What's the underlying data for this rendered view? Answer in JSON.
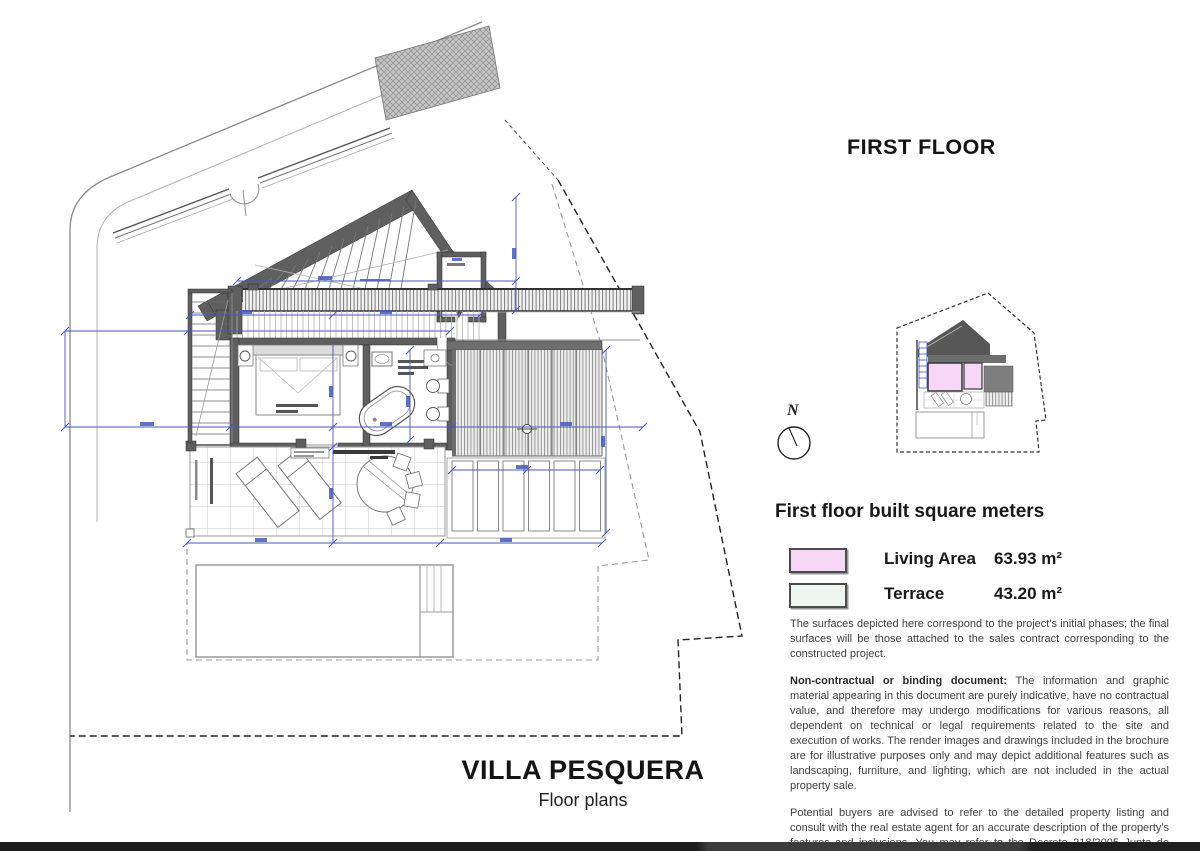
{
  "header": {
    "floor_title": "FIRST FLOOR"
  },
  "compass": {
    "label": "N"
  },
  "legend": {
    "title": "First floor built square meters",
    "items": [
      {
        "label": "Living Area",
        "value": "63.93 m²",
        "color": "#f6d7f6"
      },
      {
        "label": "Terrace",
        "value": "43.20 m²",
        "color": "#eef6f0"
      }
    ]
  },
  "notes": {
    "surfaces": "The surfaces depicted here correspond to the project's initial phases; the final surfaces will be those attached to the sales contract corresponding to the constructed project.",
    "non_contractual_lead": "Non-contractual or binding document:",
    "non_contractual_body": " The information and graphic material appearing in this document are purely indicative, have no contractual value, and therefore may undergo modifications for various reasons, all dependent on technical or legal requirements related to the site and execution of works. The render images and drawings included in the brochure are for illustrative purposes only and may depict additional features such as landscaping, furniture, and lighting, which are not included in the actual property sale.",
    "buyers": "Potential buyers are advised to refer to the detailed property listing and consult with the real estate agent for an accurate description of the property's features and inclusions. You may refer to the Decreto 218/2005 Junta de Andalucía, available at our offices."
  },
  "footer": {
    "title": "VILLA PESQUERA",
    "subtitle": "Floor plans"
  },
  "colors": {
    "living_area": "#f6d7f6",
    "terrace": "#eef6f0",
    "dimension_blue": "#4659b8",
    "wall_gray": "#5f5f5f"
  }
}
